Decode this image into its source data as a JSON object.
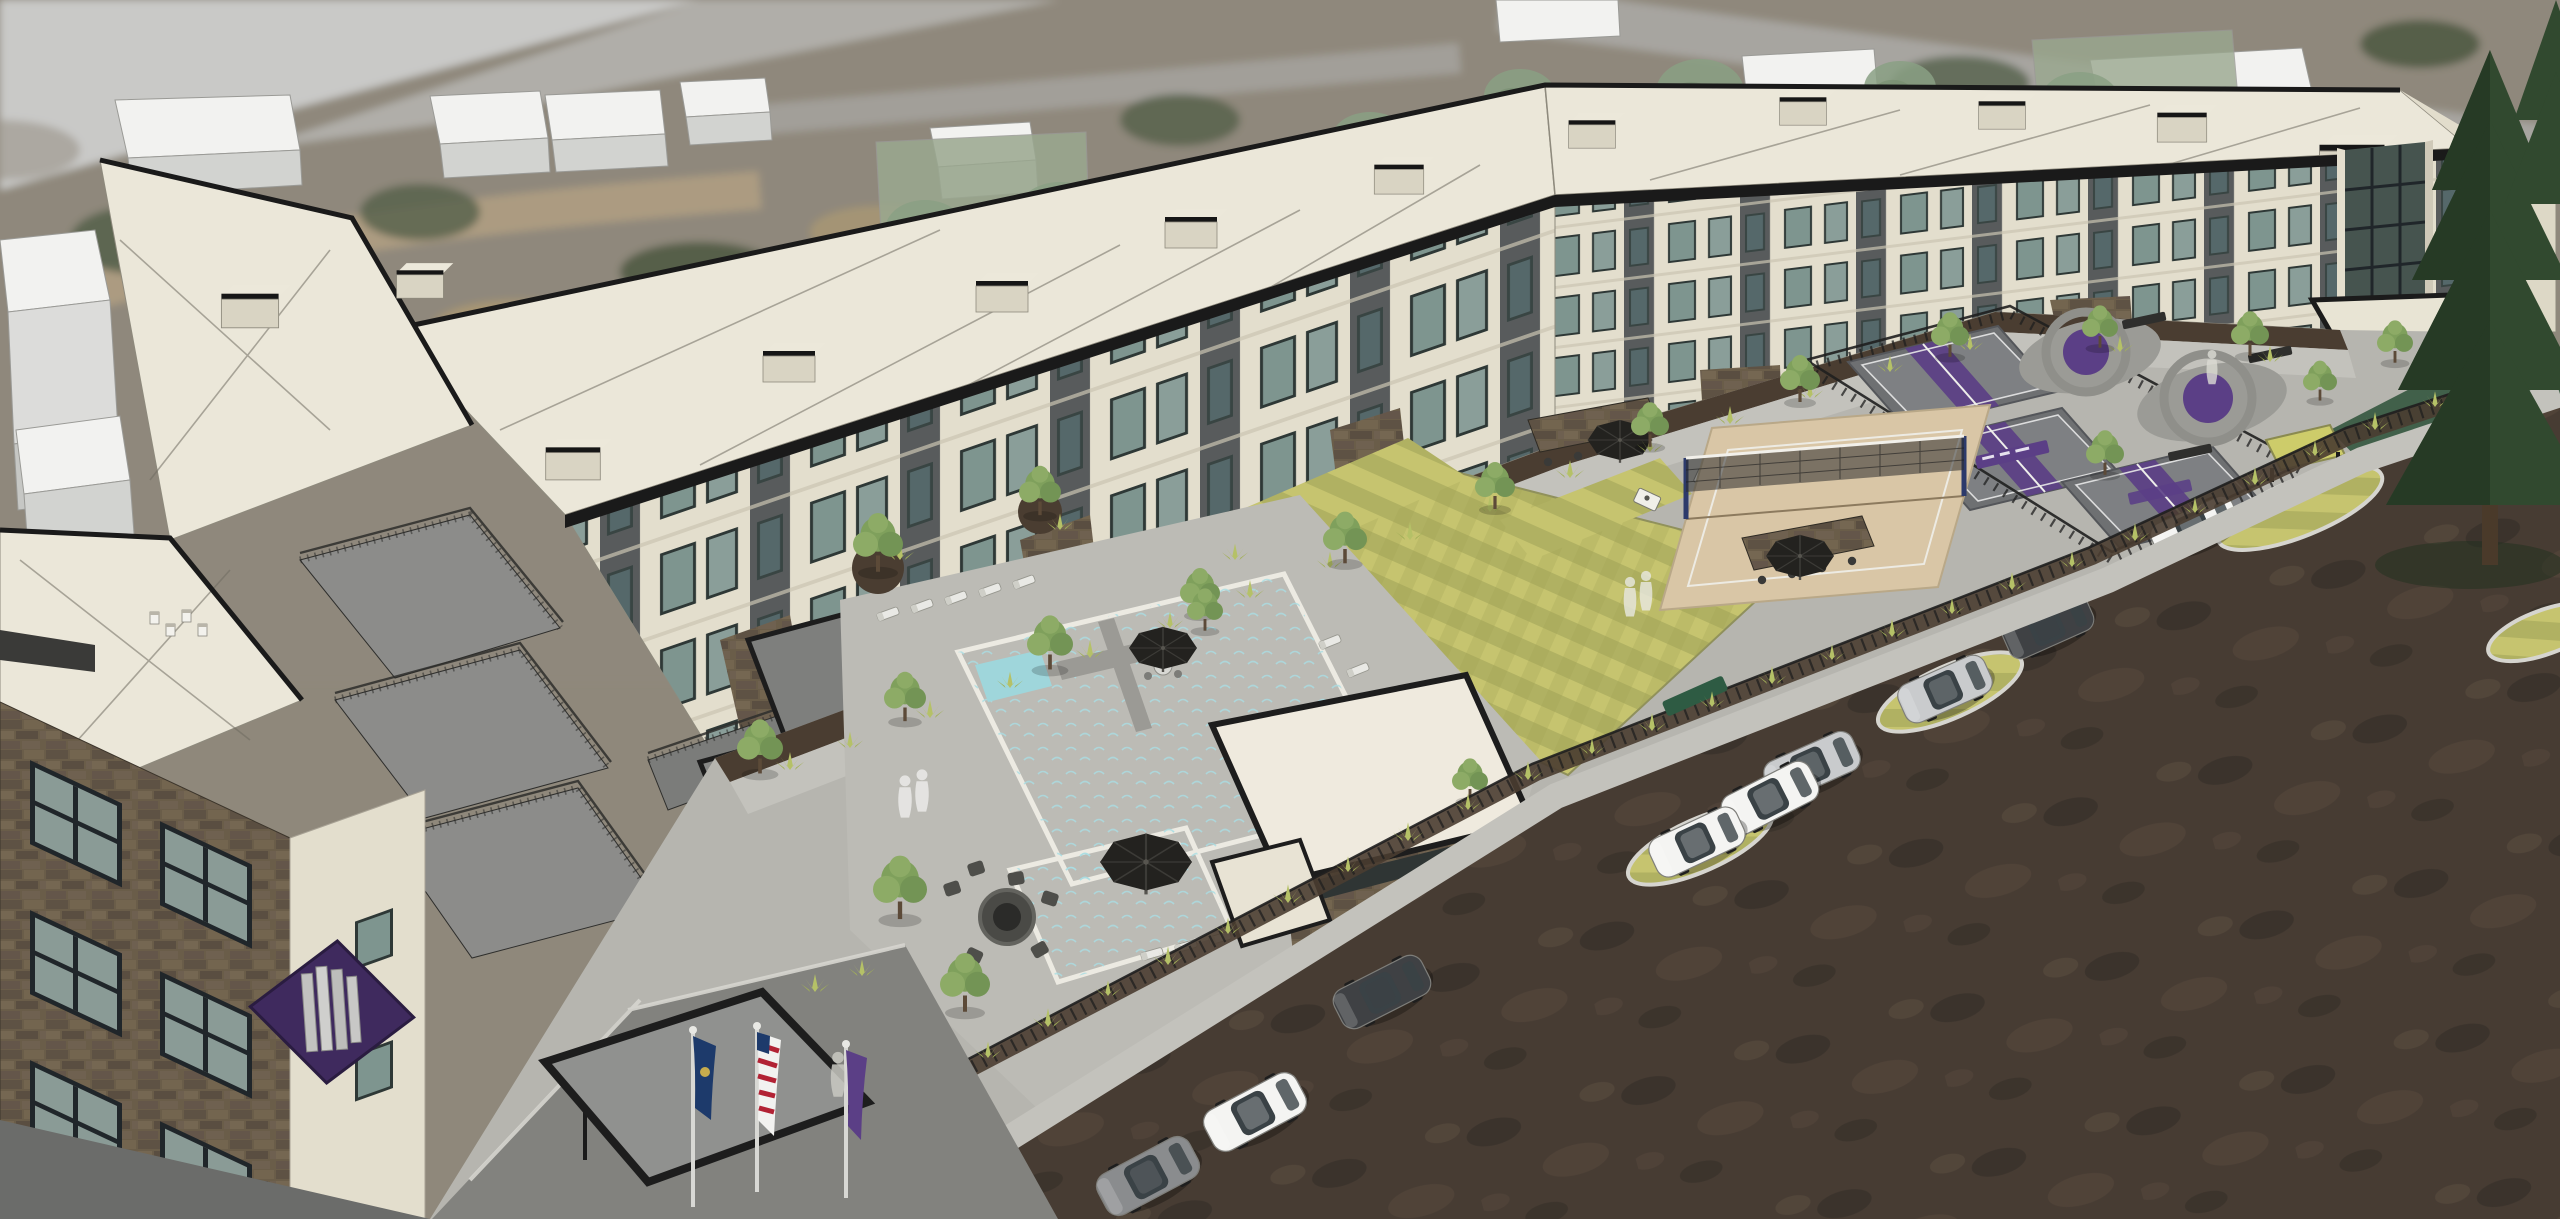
{
  "scene": {
    "type": "3D architectural aerial rendering",
    "subject": "Garden-style apartment community with amenity courtyard",
    "view": "high oblique aerial massing view over blurred satellite-photo context",
    "amenities": [
      "swimming pool with spa arm",
      "pool house",
      "fire pit lounge",
      "striped event lawn",
      "sand volleyball court",
      "pickleball courts",
      "plaza with purple circle games",
      "outdoor kitchen counters",
      "cornhole boards",
      "lounge chairs",
      "black patio umbrellas",
      "perimeter metal fence",
      "flag court at entry"
    ],
    "counts": {
      "pickleball_courts": 3,
      "umbrellas": 5,
      "flags": 3,
      "parked_cars_dirt_lot": 9,
      "people_silhouettes": 6,
      "building_floors": 5
    },
    "flags": [
      "United States flag",
      "navy state flag",
      "purple community flag"
    ],
    "car_colors": [
      "white",
      "white",
      "white",
      "white",
      "silver",
      "silver",
      "gray",
      "dark gray",
      "dark gray"
    ],
    "branding": {
      "logo": "purple diamond sign with vertical gray bars on corner of near building"
    }
  },
  "palette": {
    "aerial_base": "#8f887b",
    "aerial_road": "#b9b7b2",
    "pond_dark": "#2c2f33",
    "context_white": "#f2f2f0",
    "context_white_side": "#d2d3d0",
    "context_tree_green": "#8aa084",
    "plaza_concrete": "#b6b5af",
    "walkway": "#c3c2bc",
    "mulch": "#4a3d31",
    "building_cream": "#e3decd",
    "building_panel_dark": "#585b5c",
    "building_stone": "#6a5d49",
    "roof_cream": "#ebe7d9",
    "parapet_black": "#1a1a1a",
    "window_glass": "#7e958f",
    "terrace_gray": "#8c8c8a",
    "pool_water": "#5fb7c6",
    "lawn_light": "#c6c46f",
    "lawn_dark": "#b0b162",
    "lawn_right_dark": "#41604a",
    "sand": "#d9c6a6",
    "court_gray": "#6e7072",
    "accent_purple": "#5b3f86",
    "logo_purple": "#3f2a5e",
    "dirt_lot": "#473c33",
    "fence_black": "#1f1f1f",
    "tree_green": "#7fa05c",
    "pine_green": "#31492f",
    "car_white": "#f4f4f2",
    "car_silver": "#c9cbcd",
    "car_gray": "#8a8c8e",
    "car_dark": "#3f4144",
    "flag_navy": "#1d3a6b",
    "flag_red": "#b22234",
    "umbrella_black": "#23221f",
    "asphalt": "#82827e"
  }
}
